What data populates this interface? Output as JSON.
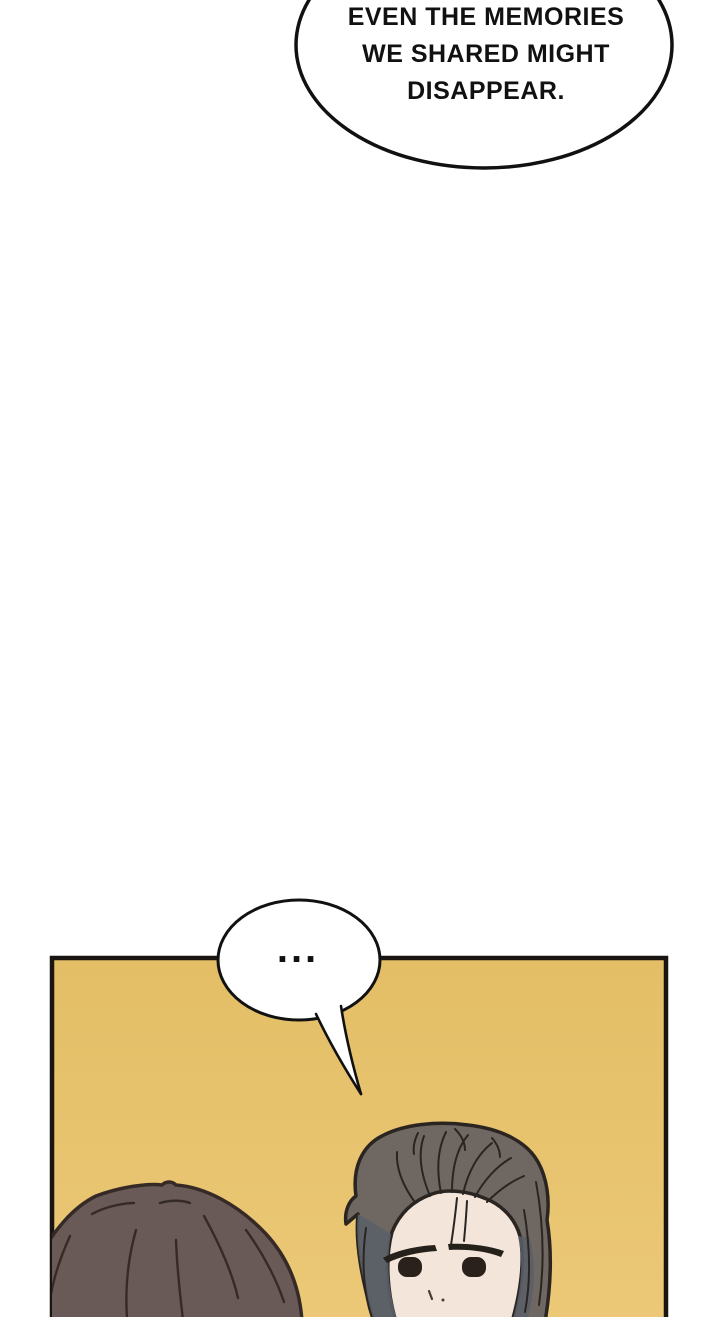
{
  "page": {
    "width": 720,
    "height": 1317,
    "background": "#ffffff"
  },
  "top_speech_bubble": {
    "kind": "dialogue-bubble",
    "lines": [
      "EVEN THE MEMORIES",
      "WE SHARED MIGHT",
      "DISAPPEAR."
    ],
    "fill": "#ffffff",
    "stroke": "#111111"
  },
  "panel": {
    "bg_top": "#e3be66",
    "bg_bottom": "#ecc978",
    "border_color": "#1a1511"
  },
  "ellipsis_bubble": {
    "text": "...",
    "fill": "#ffffff",
    "stroke": "#111111"
  },
  "characters": {
    "left_head": {
      "hair_fill": "#6a5a57",
      "line_color": "#362a27"
    },
    "man": {
      "hair_fill": "#6f6761",
      "hair_shadow": "#5a5f68",
      "line_color": "#2b2522",
      "skin_fill": "#f3e5da",
      "eye_fill": "#2a211d",
      "brow_fill": "#26201b",
      "nose_color": "#4a3b33"
    }
  }
}
